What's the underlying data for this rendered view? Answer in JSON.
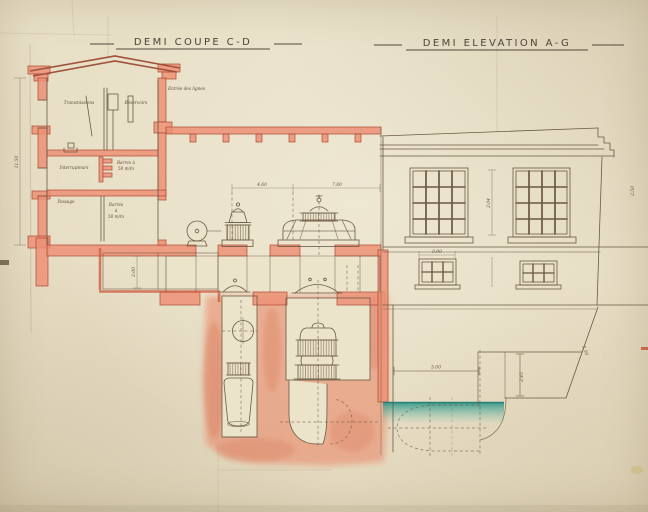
{
  "document": {
    "kind": "hand-drawn architectural plan of a small power house, sepia ink with red and teal watercolor on aged paper",
    "views": {
      "section": {
        "title": "DEMI COUPE C-D"
      },
      "elevation": {
        "title": "DEMI ELEVATION A-G"
      }
    }
  },
  "labels": {
    "entree_lignes": "Entrée des lignes",
    "room_top_left": "Transmissions",
    "room_top_right": "Réservoirs",
    "room_mid_left": "Interrupteurs",
    "room_mid_right_l1": "Barres à",
    "room_mid_right_l2": "50 m/m",
    "room_low_left": "Passage",
    "room_low_right_l1": "Barres",
    "room_low_right_l2": "à",
    "room_low_right_l3": "50 m/m"
  },
  "dimensions": {
    "section_height": "11.50",
    "hall_span_a": "4.60",
    "hall_span_b": "7.80",
    "basement_height": "2.00",
    "window_bay": "2.04",
    "small_window_width": "0.90",
    "outlet_width": "5.00",
    "step_height": "2.45",
    "slope": "2.50",
    "right_edge": "2.50"
  },
  "palette": {
    "paper": "#e8dfc6",
    "ink": "#6b5942",
    "title_ink": "#4e4337",
    "red_line": "#ab4a33",
    "red_wash": "#ef967a",
    "teal_water": "#2f9e8f"
  }
}
